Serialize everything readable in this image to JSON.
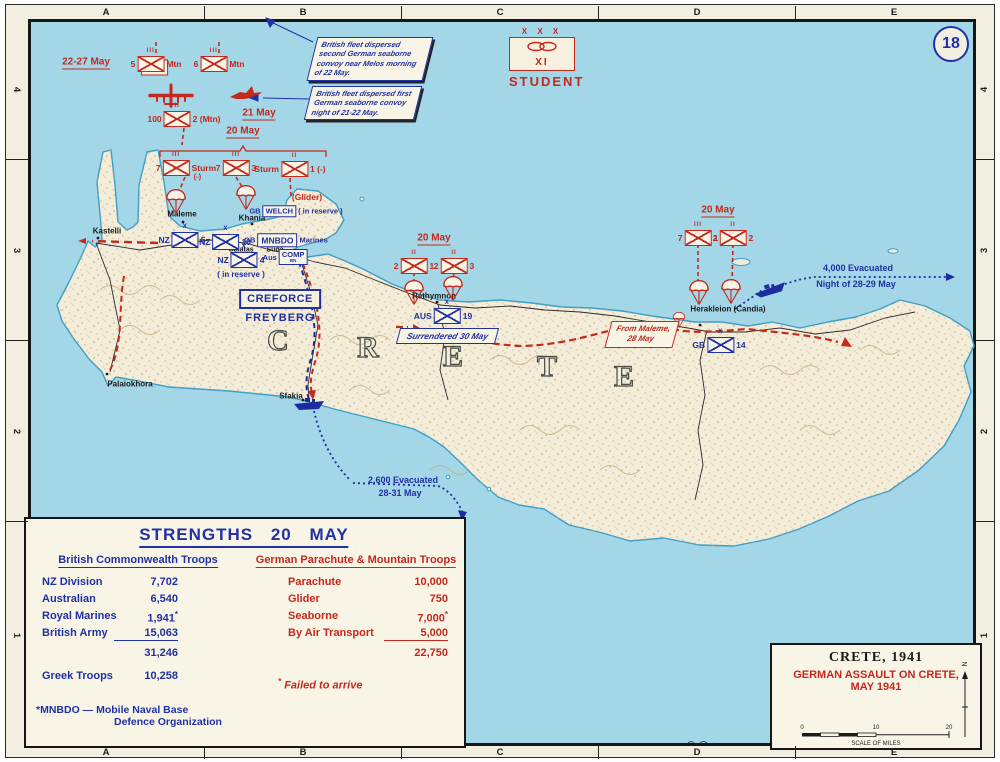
{
  "sheet": {
    "number": "18"
  },
  "grid": {
    "columns": [
      "A",
      "B",
      "C",
      "D",
      "E"
    ],
    "rows": [
      "4",
      "3",
      "2",
      "1"
    ]
  },
  "colors": {
    "sea": "#a3d6e6",
    "land": "#f2ecd8",
    "margin": "#f2efe1",
    "panel": "#f8f4e6",
    "red": "#c5281c",
    "blue": "#2131a3",
    "black": "#1b1b1b",
    "coast": "#3d9ec7",
    "terrain": "#d3bd94"
  },
  "student": {
    "echelon": "X X X",
    "designation": "XI",
    "name": "STUDENT",
    "symbol": "airborne-corps-icon"
  },
  "creforce": {
    "box": "CREFORCE",
    "commander": "FREYBERG"
  },
  "callouts": [
    {
      "text": "British fleet dispersed second German seaborne convoy near Melos morning of 22 May."
    },
    {
      "text": "British fleet dispersed first German seaborne convoy night of 21-22 May."
    }
  ],
  "flags": {
    "surrendered": "Surrendered 30 May",
    "from_maleme_1": "From Maleme,",
    "from_maleme_2": "28 May"
  },
  "map_labels": [
    {
      "t": "22-27 May",
      "x": 86,
      "y": 63,
      "c": "d-red",
      "n": "date-22-27-may"
    },
    {
      "t": "21 May",
      "x": 259,
      "y": 114,
      "c": "d-red",
      "n": "date-21-may"
    },
    {
      "t": "20 May",
      "x": 243,
      "y": 132,
      "c": "d-red",
      "n": "date-20-may-maleme"
    },
    {
      "t": "20 May",
      "x": 434,
      "y": 239,
      "c": "d-red",
      "n": "date-20-may-rethymnon"
    },
    {
      "t": "20 May",
      "x": 718,
      "y": 211,
      "c": "d-red",
      "n": "date-20-may-herakleion"
    },
    {
      "t": "(Glider)",
      "x": 307,
      "y": 197,
      "c": "r-red",
      "n": "glider-note"
    },
    {
      "t": "Kastelli",
      "x": 107,
      "y": 231,
      "c": "p-black",
      "n": "place-kastelli"
    },
    {
      "t": "Maleme",
      "x": 182,
      "y": 214,
      "c": "p-black",
      "n": "place-maleme"
    },
    {
      "t": "Khania",
      "x": 252,
      "y": 218,
      "c": "p-black",
      "n": "place-khania"
    },
    {
      "t": "Galatas",
      "x": 241,
      "y": 250,
      "c": "p-small",
      "n": "place-galatas"
    },
    {
      "t": "Suda",
      "x": 275,
      "y": 250,
      "c": "p-small",
      "n": "place-suda"
    },
    {
      "t": "Palaiokhora",
      "x": 130,
      "y": 384,
      "c": "p-black",
      "n": "place-palaiokhora"
    },
    {
      "t": "Sfakia",
      "x": 291,
      "y": 396,
      "c": "p-black",
      "n": "place-sfakia"
    },
    {
      "t": "Rethymnon",
      "x": 434,
      "y": 296,
      "c": "p-black",
      "n": "place-rethymnon"
    },
    {
      "t": "Herakleion (Candia)",
      "x": 728,
      "y": 309,
      "c": "p-black",
      "n": "place-herakleion"
    },
    {
      "t": "4,000 Evacuated",
      "x": 858,
      "y": 268,
      "c": "t-blue",
      "n": "evac-herakleion-line1"
    },
    {
      "t": "Night of 28-29 May",
      "x": 856,
      "y": 284,
      "c": "t-blue",
      "n": "evac-herakleion-line2"
    },
    {
      "t": "2,600 Evacuated",
      "x": 403,
      "y": 480,
      "c": "t-blue",
      "n": "evac-sfakia-line1"
    },
    {
      "t": "28-31 May",
      "x": 400,
      "y": 493,
      "c": "t-blue",
      "n": "evac-sfakia-line2"
    }
  ],
  "units": [
    {
      "s": "g",
      "x": 156,
      "y": 64,
      "e": "III",
      "l": "5",
      "r": "Mtn",
      "shadow": true
    },
    {
      "s": "g",
      "x": 219,
      "y": 64,
      "e": "III",
      "l": "6",
      "r": "Mtn"
    },
    {
      "s": "g",
      "x": 184,
      "y": 119,
      "e": "II",
      "l": "100",
      "r": "2 (Mtn)"
    },
    {
      "s": "g",
      "x": 186,
      "y": 168,
      "e": "III",
      "l": "7",
      "r": "Sturm",
      "sub": "(-)"
    },
    {
      "s": "g",
      "x": 236,
      "y": 168,
      "e": "III",
      "l": "7",
      "r": "3"
    },
    {
      "s": "g",
      "x": 290,
      "y": 169,
      "e": "II",
      "l": "Sturm",
      "r": "1 (-)"
    },
    {
      "s": "g",
      "x": 414,
      "y": 266,
      "e": "II",
      "l": "2",
      "r": "1"
    },
    {
      "s": "g",
      "x": 454,
      "y": 266,
      "e": "II",
      "l": "2",
      "r": "3"
    },
    {
      "s": "g",
      "x": 698,
      "y": 238,
      "e": "III",
      "l": "7",
      "r": "1"
    },
    {
      "s": "g",
      "x": 733,
      "y": 238,
      "e": "II",
      "l": "2",
      "r": "2"
    },
    {
      "s": "b",
      "x": 182,
      "y": 240,
      "e": "X",
      "l": "NZ",
      "r": "5"
    },
    {
      "s": "b",
      "x": 225,
      "y": 242,
      "e": "X",
      "l": "NZ",
      "r": "10"
    },
    {
      "s": "b",
      "x": 241,
      "y": 260,
      "e": "X",
      "l": "NZ",
      "r": "4",
      "note": "( in reserve )"
    },
    {
      "s": "b",
      "x": 443,
      "y": 316,
      "e": "X",
      "l": "AUS",
      "r": "19"
    },
    {
      "s": "b",
      "x": 719,
      "y": 345,
      "e": "X",
      "l": "GB",
      "r": "14"
    }
  ],
  "boxed_units": [
    {
      "x": 296,
      "y": 211,
      "pre": "GB",
      "box": [
        "WELCH"
      ],
      "suf": "( in reserve )",
      "big": false
    },
    {
      "x": 286,
      "y": 240,
      "pre": "GB",
      "box": [
        "MNBDO"
      ],
      "suf": "Marines",
      "big": true
    },
    {
      "x": 285,
      "y": 257,
      "pre": "Aus",
      "box": [
        "COMP",
        "BN"
      ],
      "suf": "",
      "big": false
    }
  ],
  "parachutes": [
    {
      "x": 176,
      "y": 205,
      "s": 22
    },
    {
      "x": 246,
      "y": 201,
      "s": 22
    },
    {
      "x": 414,
      "y": 296,
      "s": 22
    },
    {
      "x": 453,
      "y": 292,
      "s": 22
    },
    {
      "x": 699,
      "y": 296,
      "s": 22
    },
    {
      "x": 731,
      "y": 295,
      "s": 22
    },
    {
      "x": 679,
      "y": 323,
      "s": 14
    }
  ],
  "island_letters": [
    {
      "ch": "C",
      "x": 278,
      "y": 341
    },
    {
      "ch": "R",
      "x": 368,
      "y": 348
    },
    {
      "ch": "E",
      "x": 453,
      "y": 357
    },
    {
      "ch": "T",
      "x": 547,
      "y": 367
    },
    {
      "ch": "E",
      "x": 624,
      "y": 377
    }
  ],
  "strengths": {
    "title": "STRENGTHS 20 MAY",
    "bc": {
      "heading": "British Commonwealth Troops",
      "rows": [
        {
          "label": "NZ Division",
          "value": "7,702"
        },
        {
          "label": "Australian",
          "value": "6,540"
        },
        {
          "label": "Royal Marines",
          "value": "1,941",
          "star": true
        },
        {
          "label": "British Army",
          "value": "15,063",
          "rule": true
        }
      ],
      "total": "31,246",
      "extra": {
        "label": "Greek Troops",
        "value": "10,258"
      },
      "fn1": "*MNBDO — Mobile Naval Base",
      "fn2": "Defence Organization"
    },
    "de": {
      "heading": "German Parachute & Mountain Troops",
      "rows": [
        {
          "label": "Parachute",
          "value": "10,000"
        },
        {
          "label": "Glider",
          "value": "750"
        },
        {
          "label": "Seaborne",
          "value": "7,000",
          "star": true
        },
        {
          "label": "By Air Transport",
          "value": "5,000",
          "rule": true
        }
      ],
      "total": "22,750",
      "fn_star": "*",
      "fn": "Failed to arrive"
    }
  },
  "title_box": {
    "line1": "CRETE, 1941",
    "line2": "GERMAN ASSAULT ON CRETE,",
    "line3": "MAY 1941",
    "scale_ticks": [
      "0",
      "10",
      "20"
    ],
    "scale_label": "SCALE OF MILES",
    "north": "N"
  }
}
